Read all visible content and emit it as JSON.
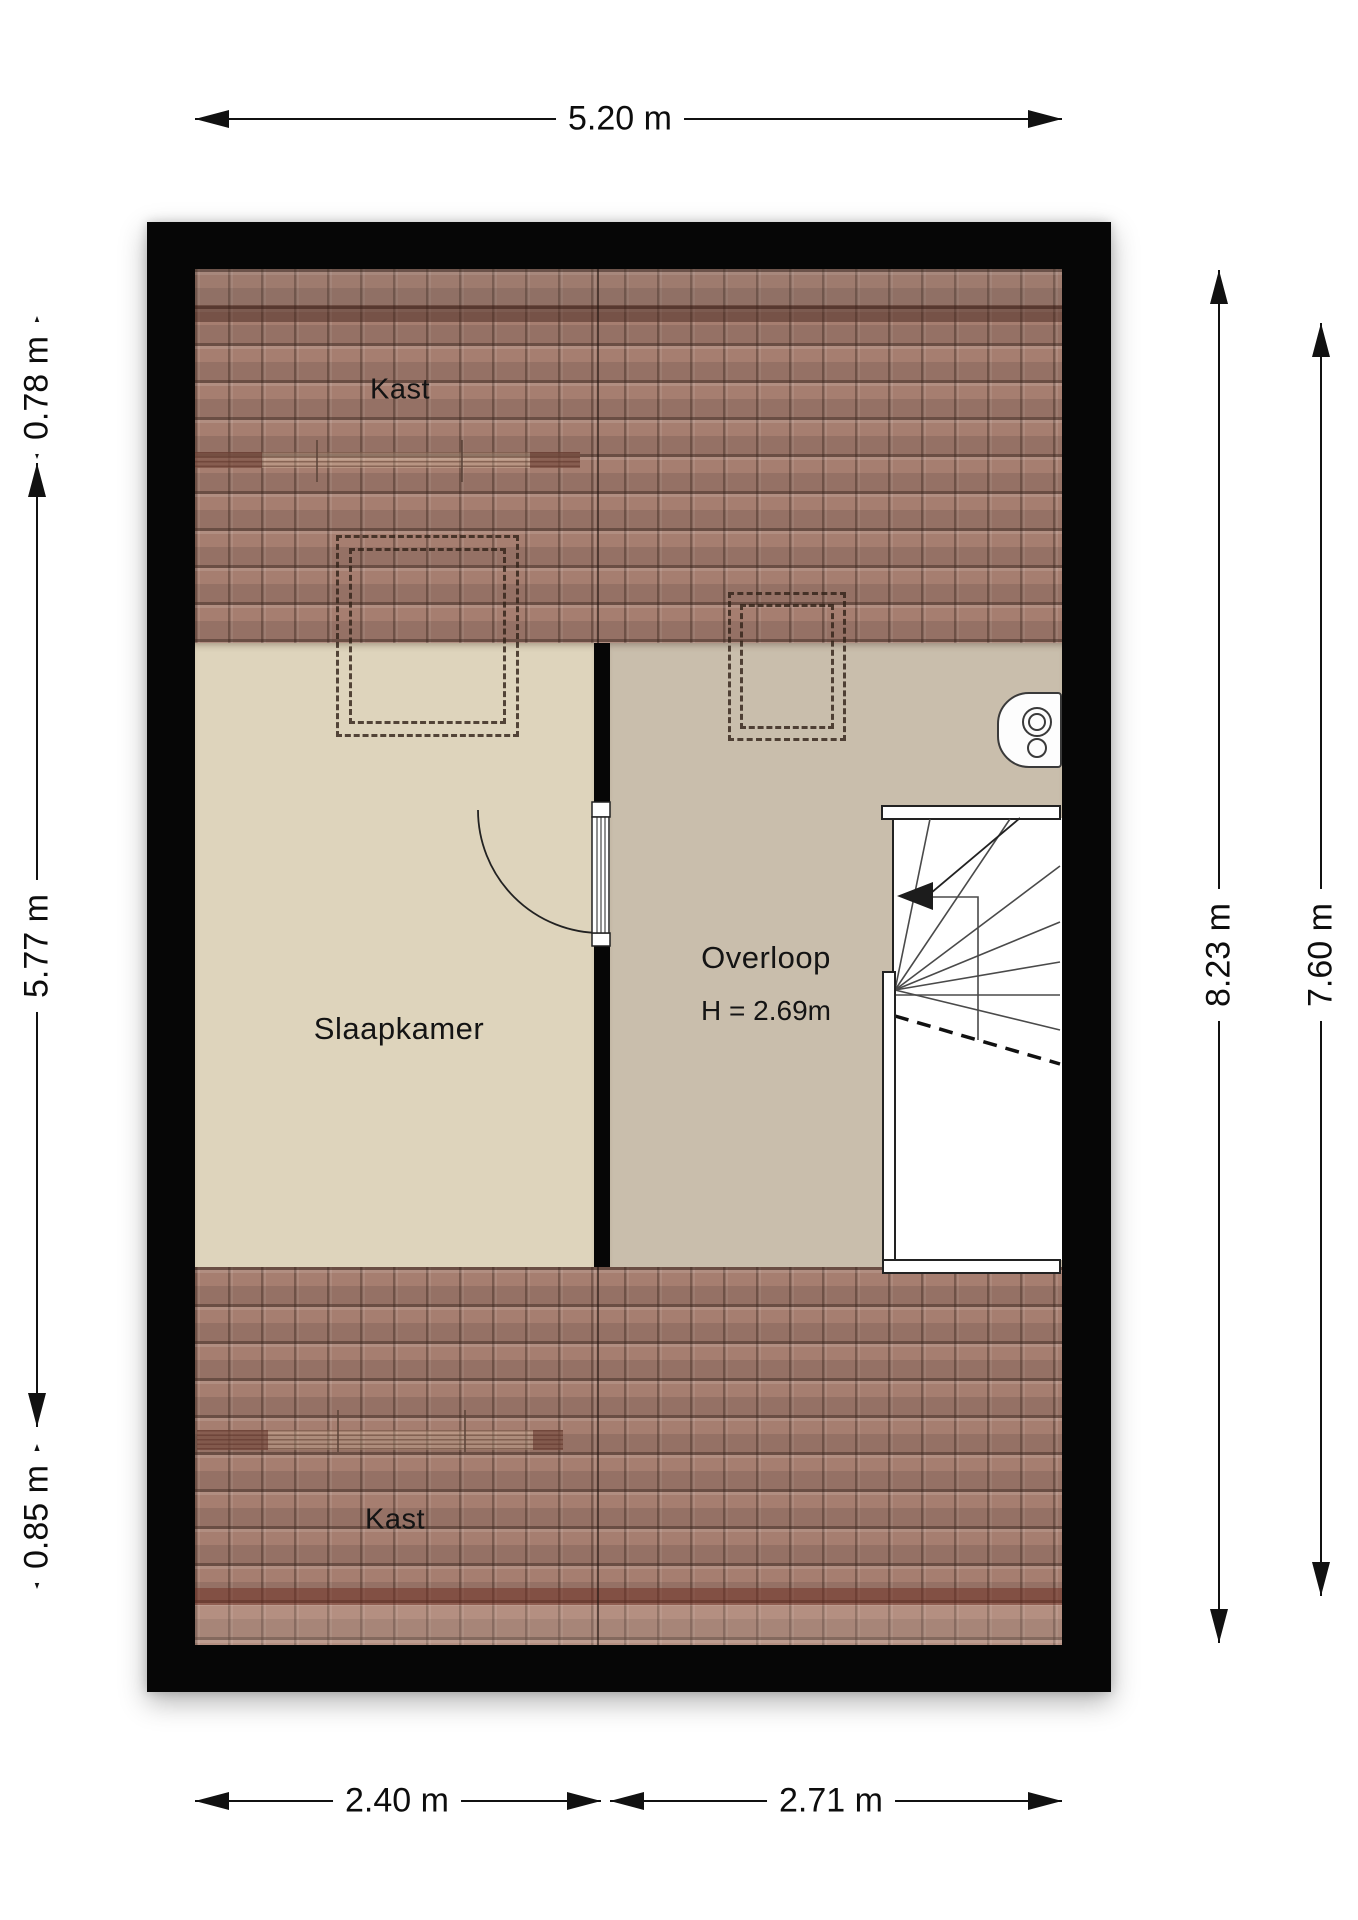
{
  "plan": {
    "title": "attic floor plan",
    "rooms": [
      {
        "name": "kast-top",
        "label": "Kast"
      },
      {
        "name": "slaapkamer",
        "label": "Slaapkamer"
      },
      {
        "name": "overloop",
        "label": "Overloop",
        "height_note": "H = 2.69m"
      },
      {
        "name": "kast-bottom",
        "label": "Kast"
      }
    ],
    "dimensions": {
      "top_width": "5.20 m",
      "left_top": "0.78 m",
      "left_middle": "5.77 m",
      "left_bottom": "0.85 m",
      "right_outer": "8.23 m",
      "right_inner": "7.60 m",
      "bottom_left": "2.40 m",
      "bottom_right": "2.71 m"
    },
    "colors": {
      "wall": "#060606",
      "roof_tile": "#a67e70",
      "floor_bedroom": "#ded4bc",
      "floor_landing": "#c9beac",
      "line": "#111111"
    }
  }
}
